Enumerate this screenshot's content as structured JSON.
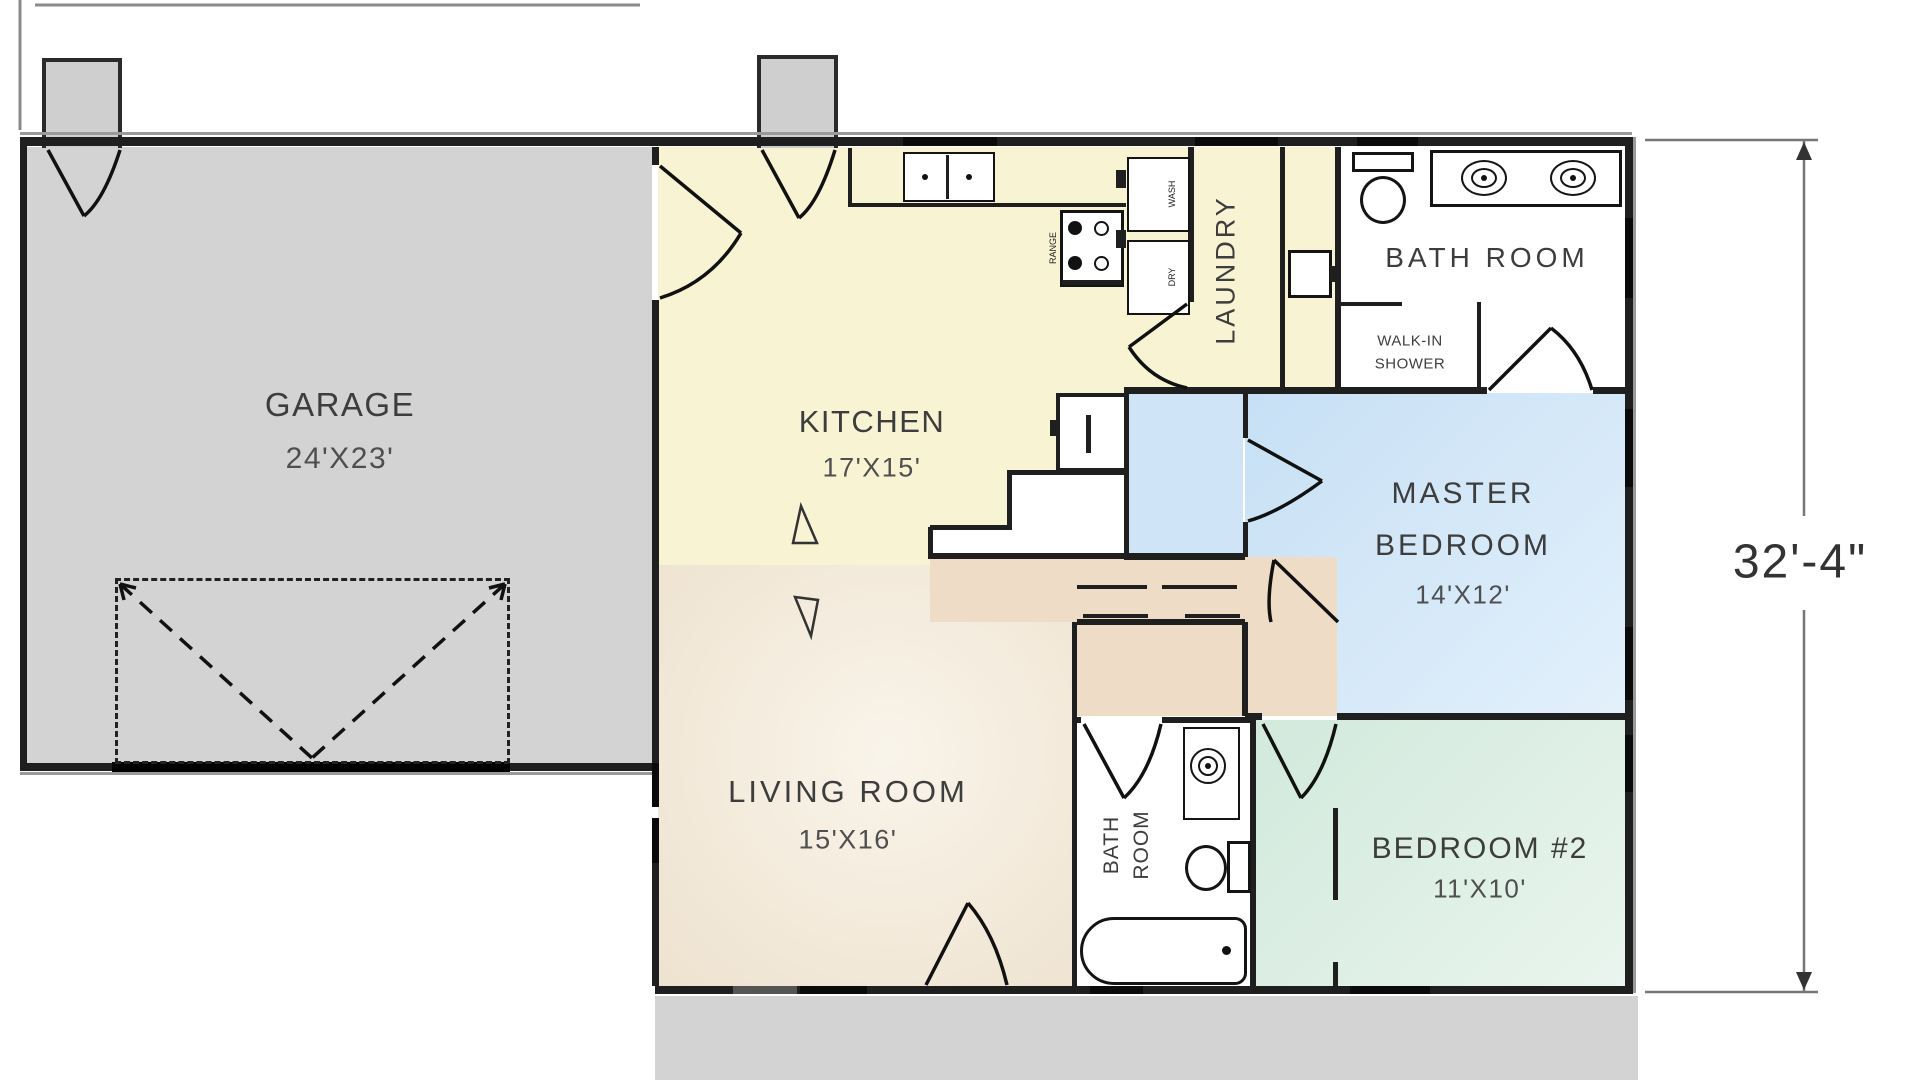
{
  "plan": {
    "garage": {
      "name": "GARAGE",
      "dims": "24'X23'"
    },
    "kitchen": {
      "name": "KITCHEN",
      "dims": "17'X15'"
    },
    "laundry": {
      "name": "LAUNDRY"
    },
    "bath1": {
      "name": "BATH ROOM",
      "shower_line1": "WALK-IN",
      "shower_line2": "SHOWER"
    },
    "master": {
      "line1": "MASTER",
      "line2": "BEDROOM",
      "dims": "14'X12'"
    },
    "living": {
      "name": "LIVING ROOM",
      "dims": "15'X16'"
    },
    "bath2": {
      "line1": "BATH",
      "line2": "ROOM"
    },
    "bedroom2": {
      "name": "BEDROOM  #2",
      "dims": "11'X10'"
    },
    "appliances": {
      "range": "RANGE",
      "washer": "WASH",
      "dryer": "DRY"
    },
    "dimension_right": "32'-4\""
  },
  "colors": {
    "garage_gray": "#d3d3d3",
    "kitchen_yellow": "#f8f3d3",
    "living_tan": "#f1e8d9",
    "hall_tan": "#eedcc6",
    "master_blue": "#cfe5f7",
    "bedroom2_green": "#d9ece1",
    "bath_white": "#ffffff",
    "wall_dark": "#1f1f1f"
  }
}
